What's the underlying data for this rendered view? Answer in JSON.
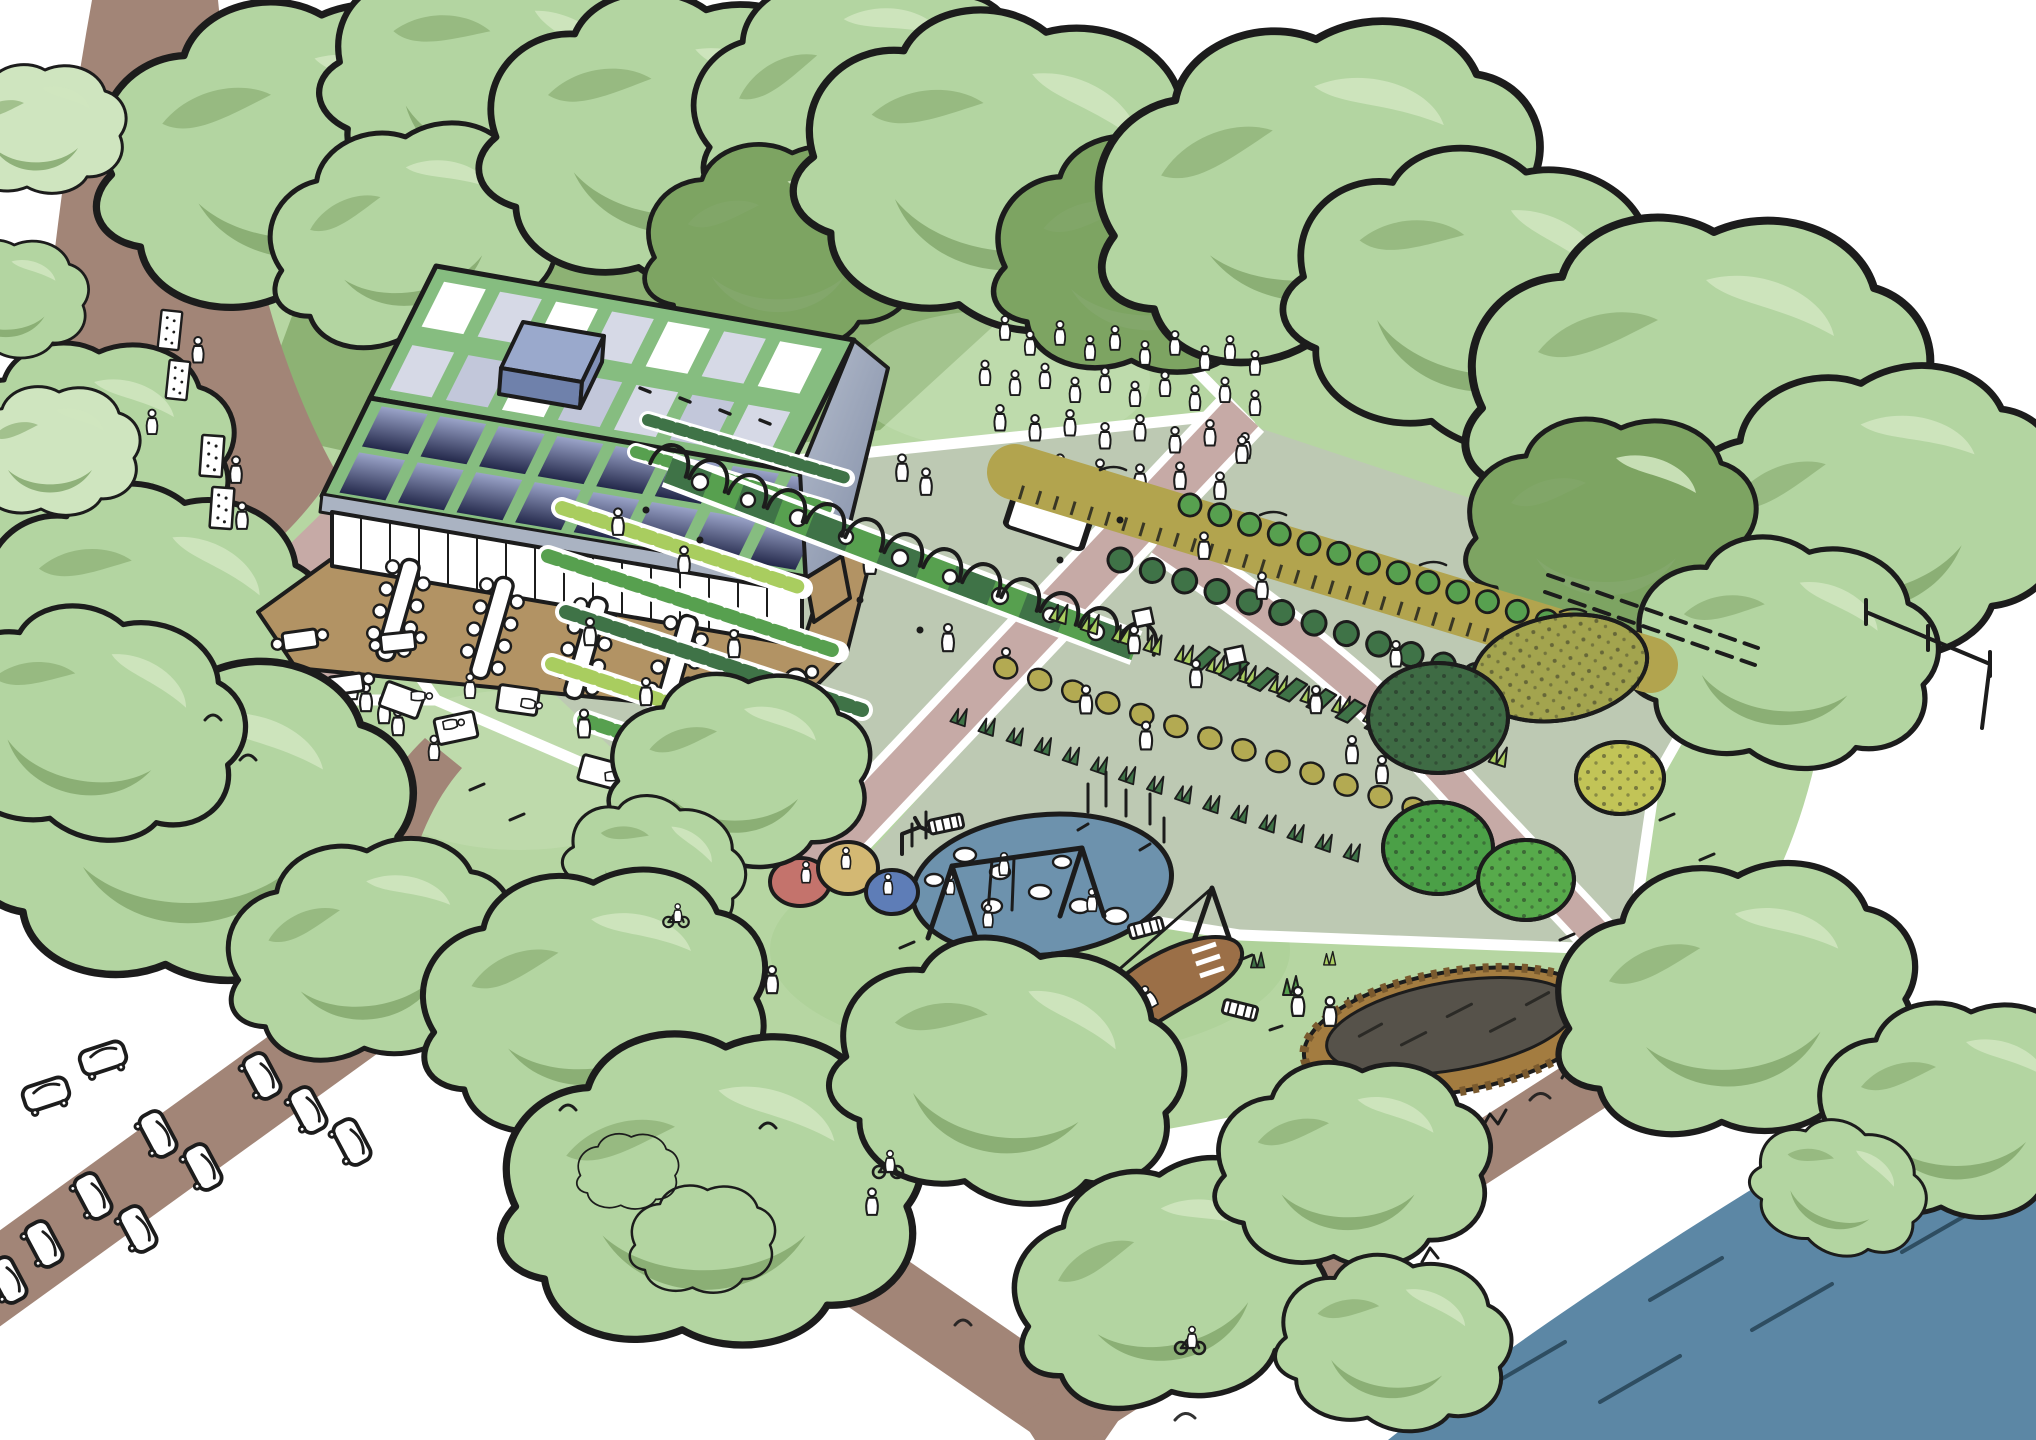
{
  "image_type": "hand-drawn aerial perspective site plan illustration (no text labels in artwork)",
  "palette": {
    "paper": "#ffffff",
    "ink": "#1c1c1c",
    "grass": "#b6d6a2",
    "grassDark": "#8db274",
    "lawnShade": "#a7cd92",
    "fieldGrey": "#bdc9b3",
    "road": "#a28577",
    "pathPink": "#c6aaa6",
    "treeFill": "#b3d5a1",
    "treeShadow": "#84a86d",
    "treeLight": "#cfe5bf",
    "treeDark": "#7da462",
    "roofGreen": "#86bd80",
    "panelTop": "#9aa3c8",
    "panelBottom": "#23284a",
    "skylight": "#ffffff",
    "skylightDim": "#d6d9e6",
    "boxTop": "#9aa9cc",
    "boxFront": "#6f81ab",
    "gableLight": "#b7bfce",
    "gableDark": "#7e8aa4",
    "eave": "#aab3c2",
    "wallTan": "#b29364",
    "deck": "#b29364",
    "pond": "#6d92ad",
    "river": "#5c87a5",
    "riverDark": "#2e4d61",
    "moundRed": "#c4736c",
    "moundYellow": "#d3b873",
    "moundBlue": "#5e7db7",
    "wheat": "#b2a44e",
    "cropDark": "#3f7347",
    "cropBright": "#57a04f",
    "cropChartreuse": "#a9cd5f",
    "cropOlive": "#b3aa52",
    "dirt": "#9b6f47",
    "compostFill": "#56524a",
    "compostRim": "#a37c40",
    "trunk": "#8a6f5c"
  },
  "areas": {
    "scene": {
      "label": "Aerial sketch of a community farm park beside a river"
    },
    "road_west": {
      "label": "Tree-lined approach road with market stalls"
    },
    "parking": {
      "label": "Car parking along access road"
    },
    "building": {
      "label": "Community building with solar panel roof and terrace dining"
    },
    "picnic_lawn": {
      "label": "Picnic lawn with tables and blankets"
    },
    "event_lawn": {
      "label": "Event lawn with gathered crowd"
    },
    "kitchen_garden": {
      "label": "Kitchen garden beds with growers"
    },
    "trellis_tunnel": {
      "label": "Arched trellis walkway through the garden"
    },
    "crop_field": {
      "label": "Crop rows and grain strip with pickers"
    },
    "orchard": {
      "label": "Orchard and forest garden"
    },
    "pond": {
      "label": "Natural play pond with stepping stones and reeds"
    },
    "playground": {
      "label": "Play area with swings, zip line, dirt slide and play mounds"
    },
    "growing_mound": {
      "label": "Raised oval planting bed with timber edge"
    },
    "river": {
      "label": "River with sketched banks"
    },
    "riverside_path": {
      "label": "Riverside path with cyclists"
    }
  }
}
